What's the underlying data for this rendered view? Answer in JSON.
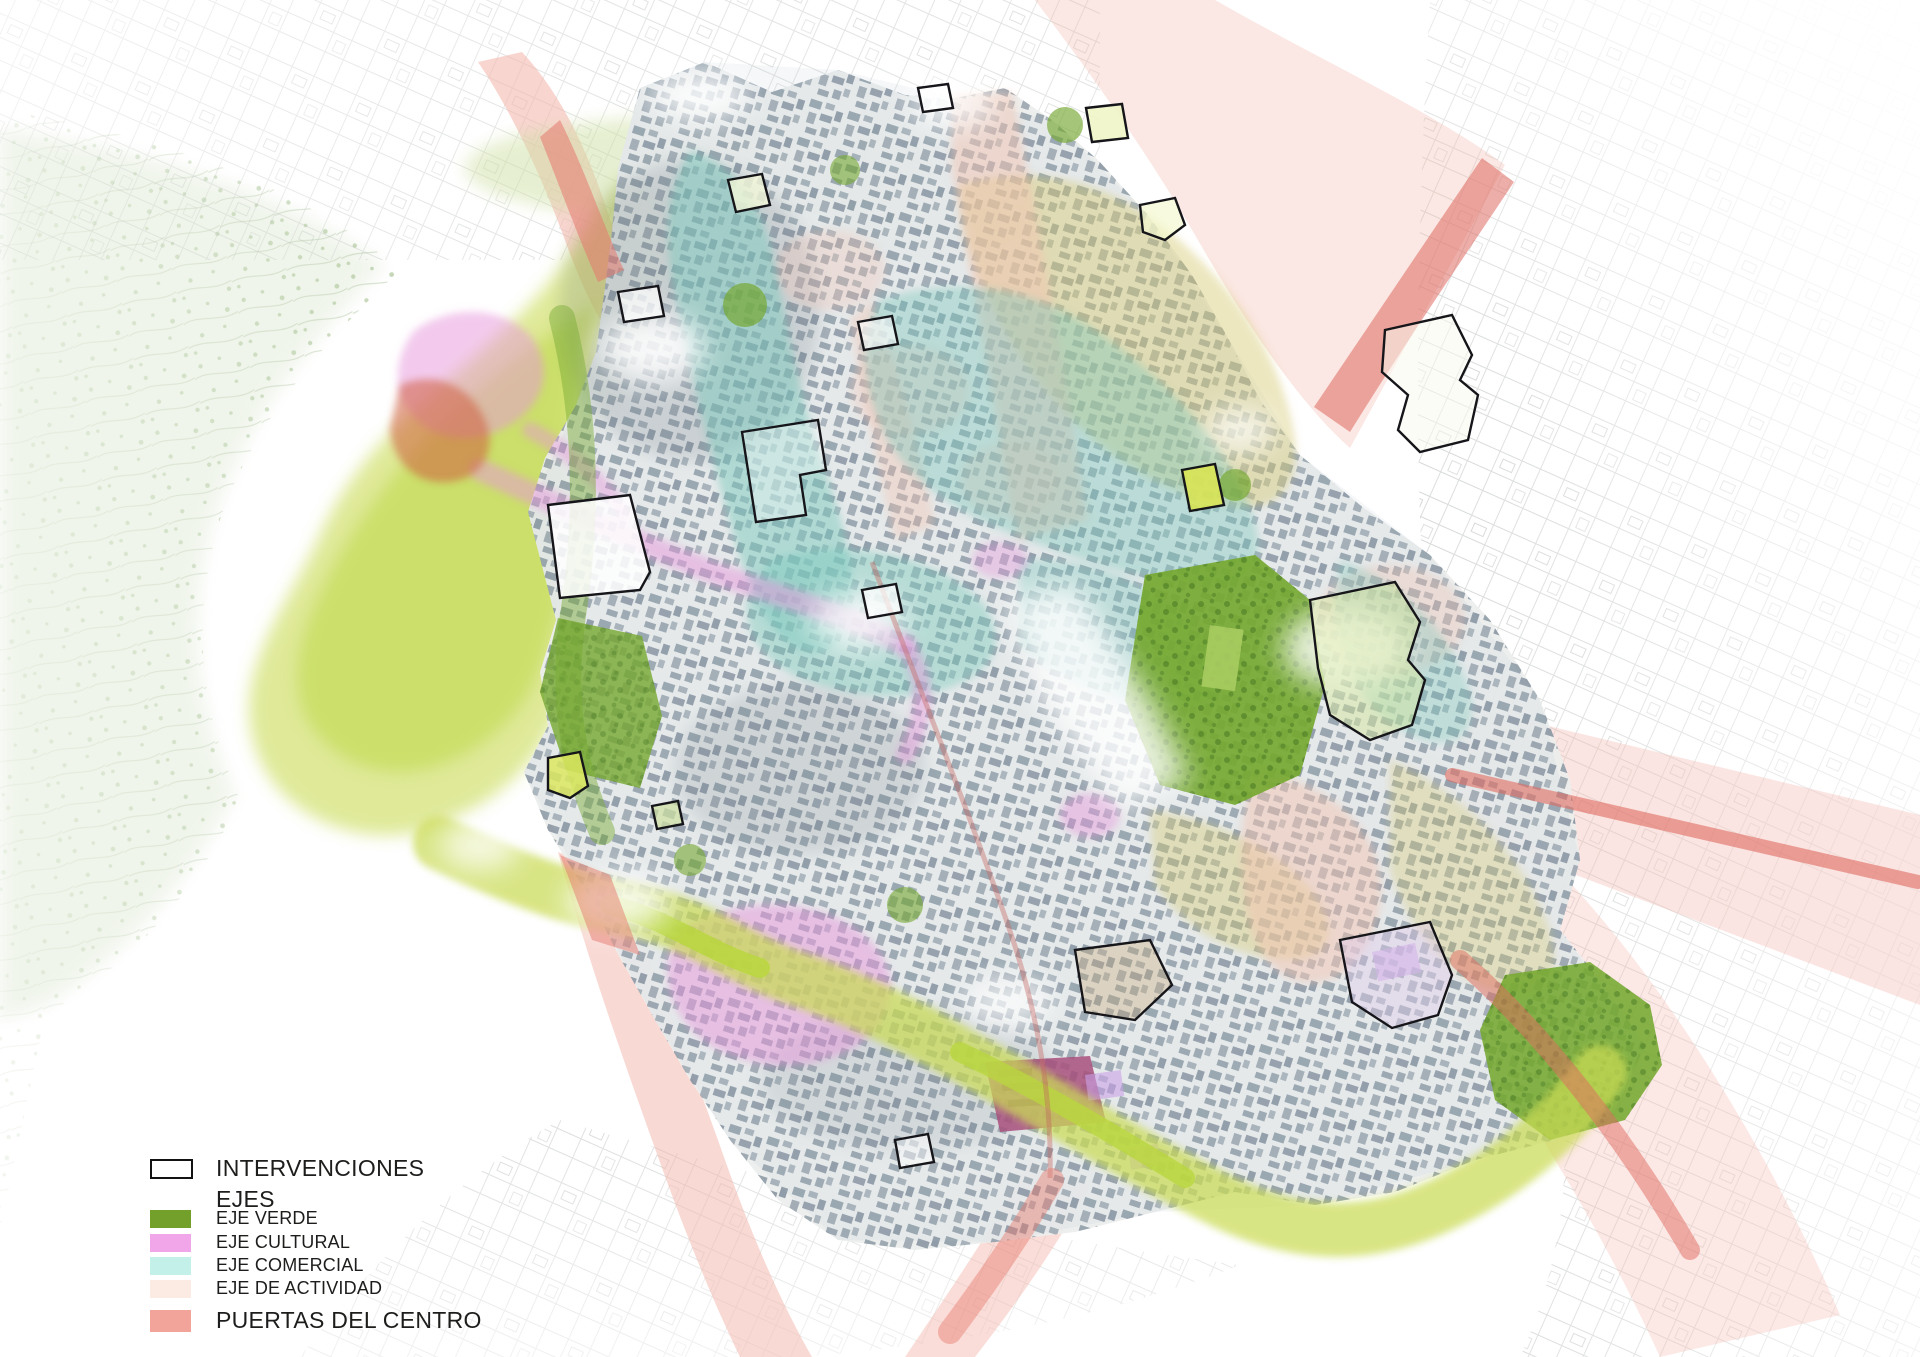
{
  "legend": {
    "interventions": {
      "label": "INTERVENCIONES",
      "swatch_fill": "#ffffff",
      "swatch_border": "#121212"
    },
    "ejes_header": {
      "label": "EJES"
    },
    "items": [
      {
        "id": "eje-verde",
        "label": "EJE VERDE",
        "color": "#73a02a"
      },
      {
        "id": "eje-cultural",
        "label": "EJE CULTURAL",
        "color": "#f2a6ea"
      },
      {
        "id": "eje-comercial",
        "label": "EJE COMERCIAL",
        "color": "#c3f0e8"
      },
      {
        "id": "eje-actividad",
        "label": "EJE DE ACTIVIDAD",
        "color": "#fcebe3"
      }
    ],
    "puertas": {
      "label": "PUERTAS DEL CENTRO",
      "color": "#f2a49a"
    }
  },
  "map": {
    "colors": {
      "puertas_pale": "#f4b3a9",
      "puertas_strong": "#e6796e",
      "red_stripe": "#df6a60",
      "lime": "#cadb55",
      "lime_bright": "#b9d63e",
      "park_green": "#75a830",
      "park_pale": "#cfe0a4",
      "olive": "#d7ca74",
      "comercial_zone": "#7cc9bd",
      "cultural_zone": "#e795dc",
      "actividad_zone": "#f4c3b2",
      "matadero": "#a8507c",
      "terracotta": "#cf5f3f",
      "lilac": "#c9a2e6",
      "city_wash": "#aebecb",
      "countryside": "#dfe9d5",
      "rail_red": "#c4655e"
    }
  }
}
